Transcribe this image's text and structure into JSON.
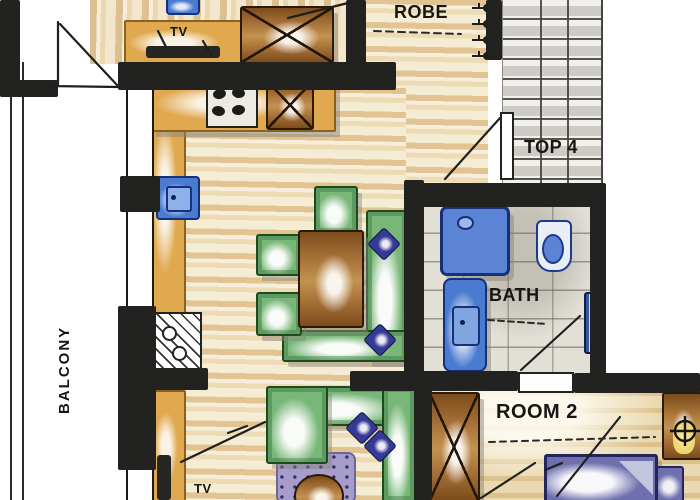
{
  "title": "Hand-drawn apartment floor plan",
  "labels": {
    "balcony": "BALCONY",
    "robe": "ROBE",
    "top4": "TOP 4",
    "bath": "BATH",
    "room2": "ROOM 2",
    "tv_upper": "TV",
    "tv_lower": "TV"
  },
  "rooms": [
    {
      "name": "Balcony",
      "label": "BALCONY"
    },
    {
      "name": "Living / Dining / Kitchen",
      "features": [
        "kitchen counter",
        "stove with 4 burners",
        "sink",
        "under-bench cabinet",
        "dining table",
        "3 chairs",
        "L-shaped bench with cushions",
        "sectional sofa",
        "rug with coffee table",
        "TV unit"
      ]
    },
    {
      "name": "Robe / Entry hall",
      "label": "ROBE",
      "features": [
        "coat hooks",
        "entry door"
      ]
    },
    {
      "name": "Stairwell",
      "label": "TOP 4",
      "features": [
        "staircase"
      ]
    },
    {
      "name": "Bathroom",
      "label": "BATH",
      "features": [
        "shower",
        "vanity",
        "toilet",
        "towel rail"
      ]
    },
    {
      "name": "Room 2",
      "label": "ROOM 2",
      "features": [
        "double bed",
        "wardrobe",
        "nightstand with lamp"
      ]
    },
    {
      "name": "Room 1 (partially visible)",
      "features": [
        "TV cabinet",
        "wardrobe",
        "blue appliance"
      ]
    }
  ],
  "colors": {
    "wall": "#222220",
    "wood_floor": "#f5ecd4",
    "counter_tan": "#e0a94f",
    "cabinet_brown": "#a9743a",
    "furniture_green": "#79b779",
    "fixture_blue": "#4a7bd0",
    "cushion_navy": "#353a96",
    "rug_purple": "#a79dcb",
    "carpet": "#ead9b0",
    "tile_grey": "#e2dfd7"
  }
}
